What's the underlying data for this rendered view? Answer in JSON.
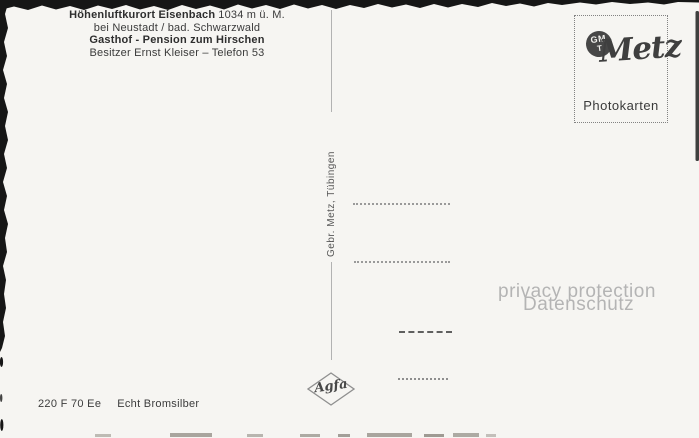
{
  "colors": {
    "paper": "#f6f5f2",
    "ink": "#3b3b3b",
    "edge_black": "#161616",
    "divider_gray": "#b2b2b2",
    "dotted_line_gray": "#9a9a9a",
    "dark_dash_gray": "#5f5f5f",
    "watermark_gray": "#b4b4b4",
    "monogram_fill": "#474747"
  },
  "header": {
    "line1_bold": "Höhenluftkurort Eisenbach",
    "line1_rest": "1034 m ü. M.",
    "line2": "bei Neustadt / bad. Schwarzwald",
    "line3": "Gasthof - Pension zum Hirschen",
    "line4": "Besitzer Ernst Kleiser – Telefon 53"
  },
  "stamp_box": {
    "monogram_top": "GM",
    "monogram_bottom": "T",
    "brand": "Metz",
    "caption": "Photokarten"
  },
  "publisher_vertical": "Gebr. Metz, Tübingen",
  "film_brand": "Agfa",
  "watermark": {
    "line1": "privacy protection",
    "line2": "Datenschutz"
  },
  "footer": {
    "code": "220 F 70 Ee",
    "paper_type": "Echt Bromsilber"
  }
}
